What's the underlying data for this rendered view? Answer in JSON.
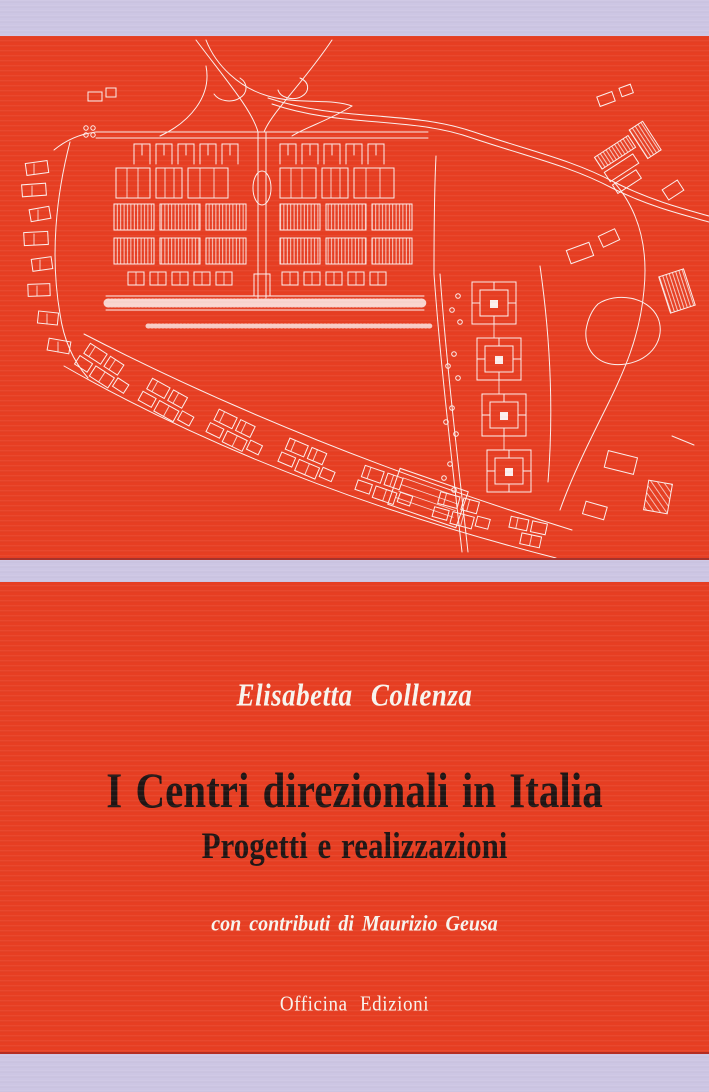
{
  "cover": {
    "author": "Elisabetta Collenza",
    "title": "I Centri direzionali in Italia",
    "subtitle": "Progetti e realizzazioni",
    "contributor_note": "con contributi di Maurizio Geusa",
    "publisher": "Officina Edizioni"
  },
  "colors": {
    "red_panel": "#e73e22",
    "lavender_background": "#cdc6e4",
    "title_text": "#201514",
    "light_text": "#f9f5ef",
    "map_line": "#ffffff"
  }
}
